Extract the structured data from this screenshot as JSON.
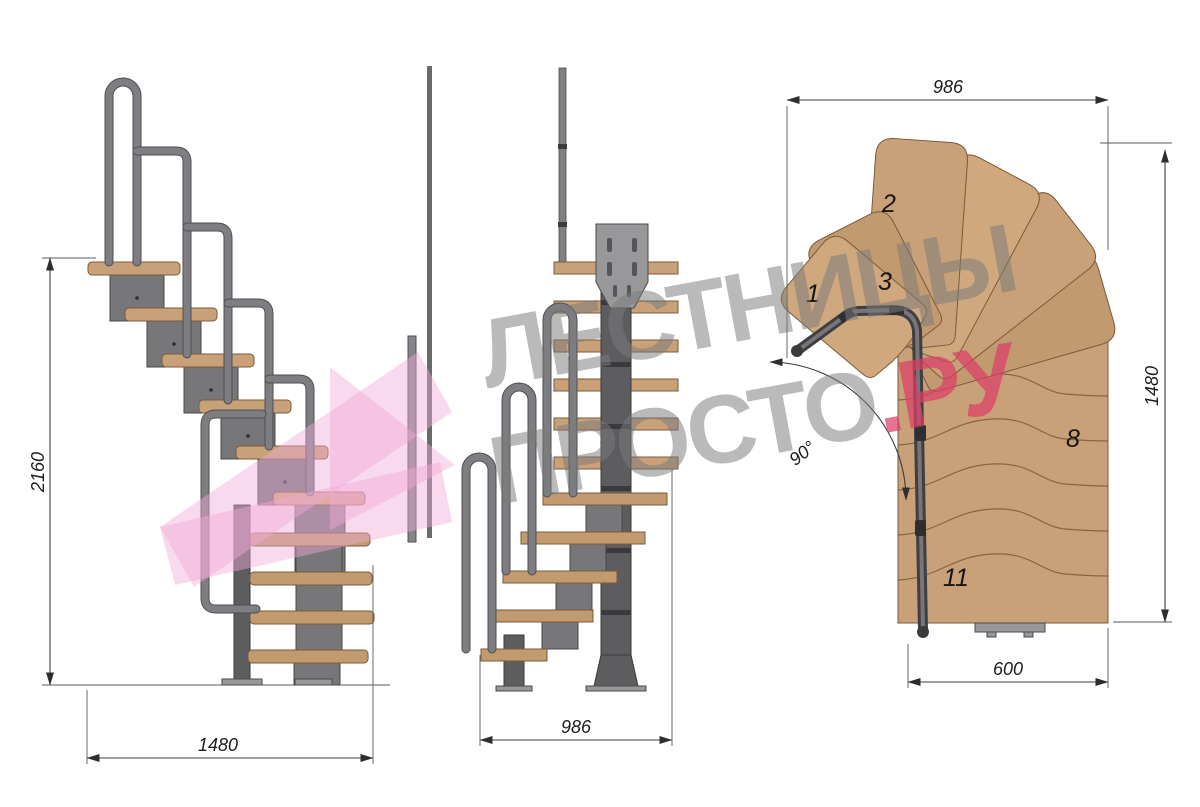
{
  "drawing": {
    "type": "modular-staircase-technical-drawing",
    "views": {
      "side": {
        "label": "side-elevation",
        "dim_height": "2160",
        "dim_width": "1480"
      },
      "front": {
        "label": "front-elevation",
        "dim_width": "986"
      },
      "plan": {
        "label": "plan-view",
        "dim_top_width": "986",
        "dim_right_depth": "1480",
        "dim_step_width": "600",
        "turn_angle": "90°",
        "step_numbers": [
          "1",
          "2",
          "3",
          "8",
          "11"
        ]
      }
    }
  },
  "watermark": {
    "line1": "ЛЕСТНИЦЫ",
    "line2": "ПРОСТО",
    "line2_suffix": ".РУ"
  },
  "colors": {
    "background": "#ffffff",
    "wood": "#c9a178",
    "wood_outline": "#7a5a3a",
    "metal": "#77777a",
    "metal_dark": "#47474a",
    "rail": "#7e7e82",
    "dimension": "#3c3c3e",
    "watermark_gray": "#7a7a7a",
    "watermark_pink": "#db3e67",
    "watermark_arrow_pink": "#f2aed6"
  }
}
